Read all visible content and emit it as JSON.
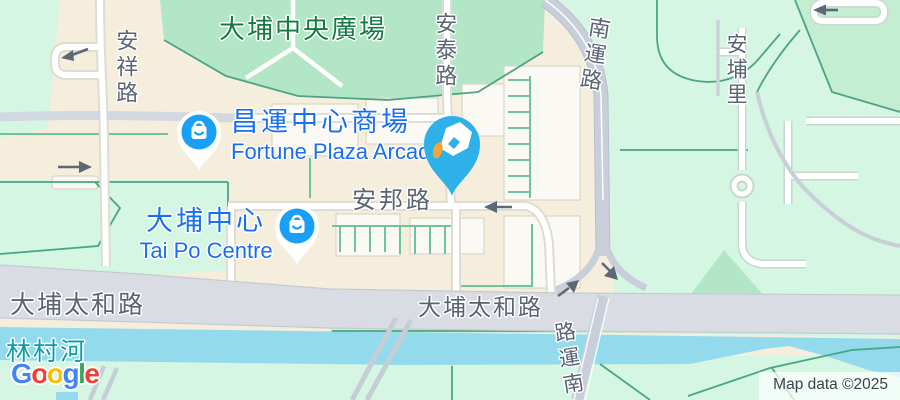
{
  "app": "google-maps-embed",
  "attribution": {
    "text": "Map data ©2025"
  },
  "logo": {
    "name": "Google",
    "letters": [
      {
        "ch": "G",
        "color": "#4285F4"
      },
      {
        "ch": "o",
        "color": "#EA4335"
      },
      {
        "ch": "o",
        "color": "#FBBC05"
      },
      {
        "ch": "g",
        "color": "#4285F4"
      },
      {
        "ch": "l",
        "color": "#34A853"
      },
      {
        "ch": "e",
        "color": "#EA4335"
      }
    ]
  },
  "labels": {
    "central_plaza": "大埔中央廣場",
    "fortune_plaza_zh": "昌運中心商場",
    "fortune_plaza_en": "Fortune Plaza Arcade",
    "tai_po_centre_zh": "大埔中心",
    "tai_po_centre_en": "Tai Po Centre",
    "on_pong_road": "安邦路",
    "tai_po_tai_wo_road_west": "大埔太和路",
    "tai_po_tai_wo_road_east": "大埔太和路",
    "lam_tsuen_river": "林村河",
    "on_cheung_road": "安祥路",
    "on_tai_road": "安泰路",
    "nam_wan_road_north": "南運路",
    "on_po_lane": "安埔里",
    "nam_wan_road_south": "南運路",
    "nam_wan_road_south_chars": [
      "南",
      "運",
      "路"
    ]
  },
  "markers": {
    "selected_place": {
      "icon": "fountain-pen-nib-pin",
      "pin_color": "#2EB0E8",
      "nib_tip_color": "#F2A33C"
    },
    "fortune_plaza": {
      "icon": "shopping-bag-pin",
      "pin_color": "#17A0F6"
    },
    "tai_po_centre": {
      "icon": "shopping-bag-pin",
      "pin_color": "#17A0F6"
    }
  },
  "colors": {
    "land": "#F5EEDD",
    "palemint": "#D4F6E3",
    "park": "#B3E6C6",
    "park2": "#C4EDD2",
    "road_band": "#D9DDE3",
    "highway": "#C8CEDA",
    "water": "#93DBEC",
    "green_line": "#6FC59B",
    "teal_line": "#49A584",
    "building": "#FBF9F3",
    "building_edge": "#DAD5C7",
    "road_label": "#5A6472",
    "park_label": "#157945",
    "water_label": "#0D9DA4",
    "poi_label": "#1A6EF0",
    "poi_pin": "#17A0F6",
    "marker_blue": "#2EB0E8",
    "marker_tip": "#F2A33C",
    "arrow": "#5C6875",
    "g_blue": "#4285F4",
    "g_red": "#EA4335",
    "g_yellow": "#FBBC05",
    "g_green": "#34A853",
    "attrib_text": "#3D4248"
  }
}
